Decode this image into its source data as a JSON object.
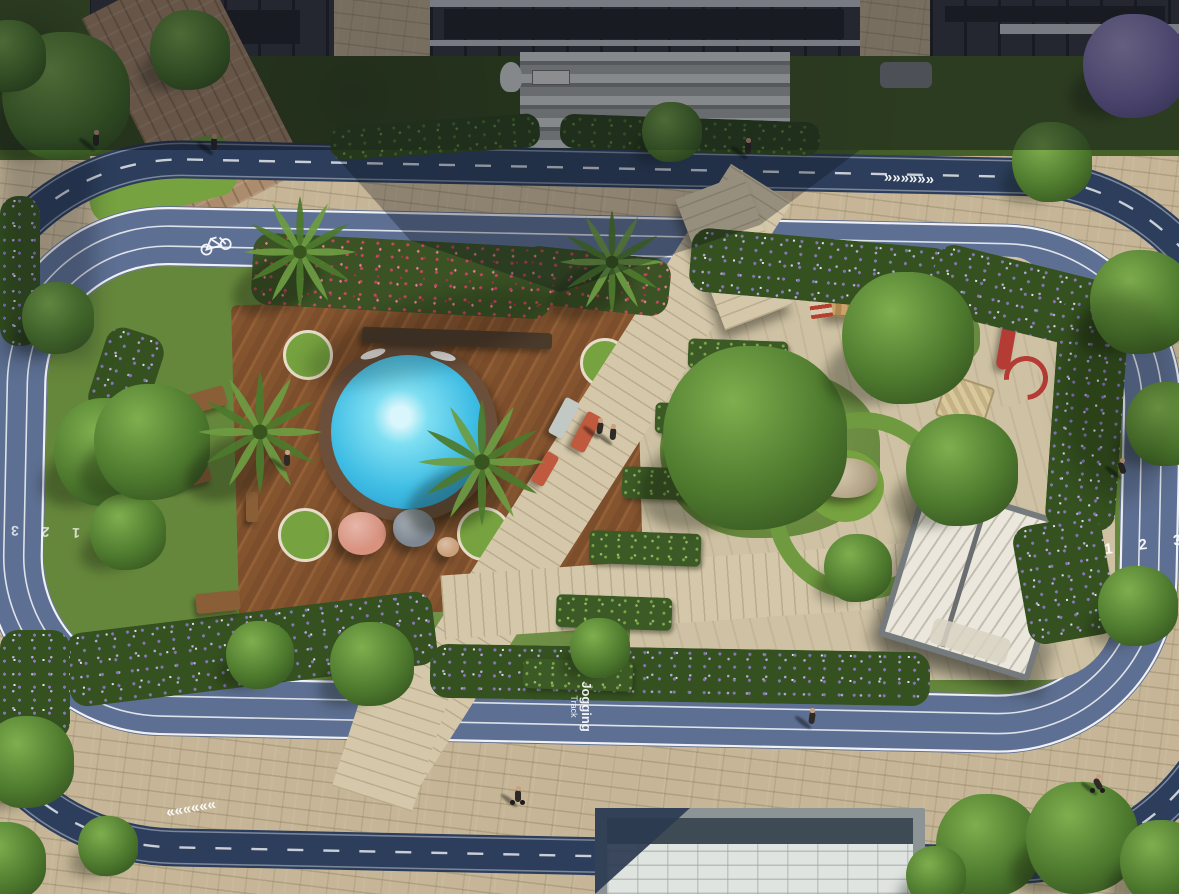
{
  "markings": {
    "lane_numbers": "1  2  3",
    "jogging_line1": "Jogging",
    "jogging_line2": "Track",
    "chevrons_forward": "»»»»»»",
    "chevrons_backward": "««««««",
    "bicycle_icon": "bicycle-lane-symbol"
  },
  "colors": {
    "paver": "#c6b697",
    "cycle_track": "#2c3e5c",
    "jogging_track": "#5d6f92",
    "lane_line": "#ffffff",
    "grass": "#65873b",
    "deck_wood": "#84542f",
    "pool_water": "#3fbde4",
    "flower_red": "#c4475c",
    "flower_purple": "#8377b5",
    "pergola_roof": "#ebe7dc",
    "slide_red": "#b53b35",
    "rooftop_white": "#e0e4e1"
  },
  "scene": {
    "palms": [
      {
        "x": 300,
        "y": 252,
        "r": 58
      },
      {
        "x": 612,
        "y": 262,
        "r": 54
      },
      {
        "x": 260,
        "y": 432,
        "r": 64
      },
      {
        "x": 482,
        "y": 462,
        "r": 66
      }
    ],
    "trees": [
      {
        "x": 755,
        "y": 438,
        "r": 92
      },
      {
        "x": 908,
        "y": 338,
        "r": 66
      },
      {
        "x": 962,
        "y": 470,
        "r": 56
      },
      {
        "x": 858,
        "y": 568,
        "r": 34
      },
      {
        "x": 108,
        "y": 452,
        "r": 54
      },
      {
        "x": 128,
        "y": 532,
        "r": 38
      },
      {
        "x": 372,
        "y": 664,
        "r": 42
      },
      {
        "x": 600,
        "y": 648,
        "r": 30
      },
      {
        "x": 260,
        "y": 655,
        "r": 34
      },
      {
        "x": 1142,
        "y": 302,
        "r": 52
      },
      {
        "x": 1168,
        "y": 424,
        "r": 42
      },
      {
        "x": 1138,
        "y": 606,
        "r": 40
      },
      {
        "x": 1052,
        "y": 162,
        "r": 40
      },
      {
        "x": 672,
        "y": 132,
        "r": 30
      },
      {
        "x": 152,
        "y": 442,
        "r": 58
      },
      {
        "x": 58,
        "y": 318,
        "r": 36
      },
      {
        "x": 988,
        "y": 846,
        "r": 52
      },
      {
        "x": 1082,
        "y": 838,
        "r": 56
      },
      {
        "x": 1162,
        "y": 862,
        "r": 42
      },
      {
        "x": 936,
        "y": 876,
        "r": 30
      },
      {
        "x": 28,
        "y": 762,
        "r": 46
      },
      {
        "x": 6,
        "y": 862,
        "r": 40
      },
      {
        "x": 108,
        "y": 846,
        "r": 30
      },
      {
        "x": 66,
        "y": 96,
        "r": 64
      },
      {
        "x": 190,
        "y": 50,
        "r": 40
      },
      {
        "x": 10,
        "y": 56,
        "r": 36
      },
      {
        "x": 1135,
        "y": 66,
        "r": 52,
        "purple": true
      }
    ],
    "flower_beds": [
      {
        "x": 252,
        "y": 240,
        "w": 300,
        "h": 72,
        "rot": 3,
        "palette": "red"
      },
      {
        "x": 520,
        "y": 252,
        "w": 150,
        "h": 58,
        "rot": 6,
        "palette": "red"
      },
      {
        "x": 690,
        "y": 238,
        "w": 260,
        "h": 64,
        "rot": 5,
        "palette": "purple"
      },
      {
        "x": 930,
        "y": 262,
        "w": 180,
        "h": 70,
        "rot": 14,
        "palette": "purple"
      },
      {
        "x": 1052,
        "y": 300,
        "w": 70,
        "h": 230,
        "rot": 4,
        "palette": "purple"
      },
      {
        "x": 1020,
        "y": 520,
        "w": 90,
        "h": 120,
        "rot": -10,
        "palette": "purple"
      },
      {
        "x": 430,
        "y": 648,
        "w": 500,
        "h": 54,
        "rot": 1,
        "palette": "purple"
      },
      {
        "x": 66,
        "y": 612,
        "w": 370,
        "h": 74,
        "rot": -7,
        "palette": "purple"
      },
      {
        "x": 96,
        "y": 330,
        "w": 60,
        "h": 90,
        "rot": 18,
        "palette": "purple"
      },
      {
        "x": 0,
        "y": 196,
        "w": 40,
        "h": 150,
        "rot": 0,
        "palette": "purple"
      },
      {
        "x": 0,
        "y": 630,
        "w": 70,
        "h": 110,
        "rot": 0,
        "palette": "purple"
      },
      {
        "x": 330,
        "y": 120,
        "w": 210,
        "h": 34,
        "rot": -4,
        "palette": "green"
      },
      {
        "x": 560,
        "y": 118,
        "w": 260,
        "h": 34,
        "rot": 2,
        "palette": "green"
      }
    ],
    "planters": [
      {
        "x": 688,
        "y": 340,
        "w": 100,
        "h": 30
      },
      {
        "x": 655,
        "y": 404,
        "w": 104,
        "h": 31
      },
      {
        "x": 622,
        "y": 468,
        "w": 108,
        "h": 32
      },
      {
        "x": 589,
        "y": 532,
        "w": 112,
        "h": 33
      },
      {
        "x": 556,
        "y": 596,
        "w": 116,
        "h": 33
      },
      {
        "x": 523,
        "y": 660,
        "w": 110,
        "h": 30
      }
    ],
    "furniture": [
      {
        "x": 362,
        "y": 330,
        "w": 190,
        "h": 16,
        "rot": 2,
        "fill": "#4a3a2a",
        "name": "sun-loungers-row"
      },
      {
        "x": 556,
        "y": 398,
        "w": 16,
        "h": 40,
        "rot": 28,
        "fill": "#c2c8c4",
        "name": "lounge-chair"
      },
      {
        "x": 578,
        "y": 412,
        "w": 16,
        "h": 40,
        "rot": 28,
        "fill": "#c05a3e",
        "name": "lounge-chair"
      },
      {
        "x": 538,
        "y": 452,
        "w": 14,
        "h": 34,
        "rot": 30,
        "fill": "#c05a3e",
        "name": "lounge-chair"
      },
      {
        "x": 186,
        "y": 390,
        "w": 40,
        "h": 20,
        "rot": -16,
        "fill": "#8a5f38",
        "name": "picnic-table"
      },
      {
        "x": 170,
        "y": 466,
        "w": 40,
        "h": 20,
        "rot": -16,
        "fill": "#8a5f38",
        "name": "picnic-table"
      },
      {
        "x": 196,
        "y": 592,
        "w": 44,
        "h": 20,
        "rot": -6,
        "fill": "#8a5f38",
        "name": "picnic-table"
      },
      {
        "x": 246,
        "y": 492,
        "w": 12,
        "h": 30,
        "rot": 0,
        "fill": "#8a5f38",
        "name": "bench"
      }
    ],
    "bean_bags": [
      {
        "x": 362,
        "y": 536,
        "r": 24,
        "fill": "#d8927f"
      },
      {
        "x": 414,
        "y": 530,
        "r": 21,
        "fill": "#7e8892"
      },
      {
        "x": 448,
        "y": 548,
        "r": 11,
        "fill": "#c9a07a"
      }
    ],
    "people": [
      {
        "x": 600,
        "y": 430,
        "rot": 10
      },
      {
        "x": 613,
        "y": 436,
        "rot": 5
      },
      {
        "x": 287,
        "y": 462,
        "rot": 0
      },
      {
        "x": 748,
        "y": 150,
        "rot": 0
      },
      {
        "x": 812,
        "y": 720,
        "rot": 8
      },
      {
        "x": 1122,
        "y": 470,
        "rot": -20
      },
      {
        "x": 518,
        "y": 798,
        "rot": 0,
        "type": "bike"
      },
      {
        "x": 1098,
        "y": 786,
        "rot": -30,
        "type": "bike"
      },
      {
        "x": 96,
        "y": 142,
        "rot": 0
      },
      {
        "x": 214,
        "y": 146,
        "rot": 0
      }
    ]
  }
}
